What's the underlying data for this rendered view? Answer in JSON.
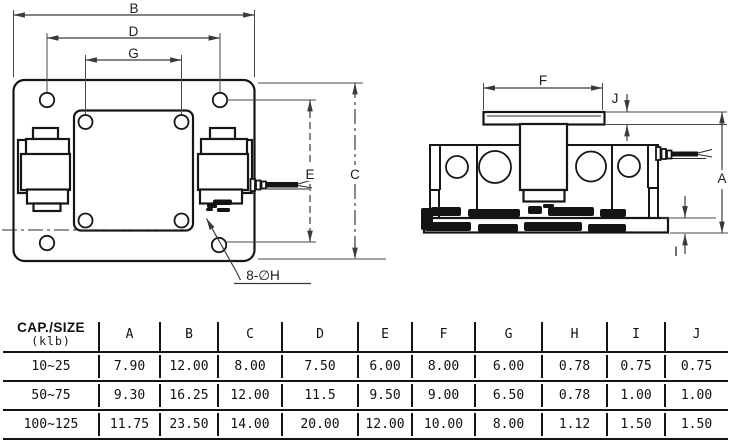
{
  "front_view": {
    "dim_labels": {
      "B": "B",
      "D": "D",
      "G": "G",
      "E": "E",
      "C": "C"
    },
    "hole_note": "8-∅H"
  },
  "side_view": {
    "dim_labels": {
      "F": "F",
      "J": "J",
      "A": "A",
      "I": "I"
    }
  },
  "table": {
    "cap_title": "CAP./SIZE",
    "cap_unit": "(klb)",
    "columns": [
      "A",
      "B",
      "C",
      "D",
      "E",
      "F",
      "G",
      "H",
      "I",
      "J"
    ],
    "rows": [
      {
        "cap": "10~25",
        "values": [
          "7.90",
          "12.00",
          "8.00",
          "7.50",
          "6.00",
          "8.00",
          "6.00",
          "0.78",
          "0.75",
          "0.75"
        ]
      },
      {
        "cap": "50~75",
        "values": [
          "9.30",
          "16.25",
          "12.00",
          "11.5",
          "9.50",
          "9.00",
          "6.50",
          "0.78",
          "1.00",
          "1.00"
        ]
      },
      {
        "cap": "100~125",
        "values": [
          "11.75",
          "23.50",
          "14.00",
          "20.00",
          "12.00",
          "10.00",
          "8.00",
          "1.12",
          "1.50",
          "1.50"
        ]
      }
    ]
  },
  "colors": {
    "line": "#161616",
    "dim": "#3a3a3a",
    "background": "#ffffff"
  }
}
